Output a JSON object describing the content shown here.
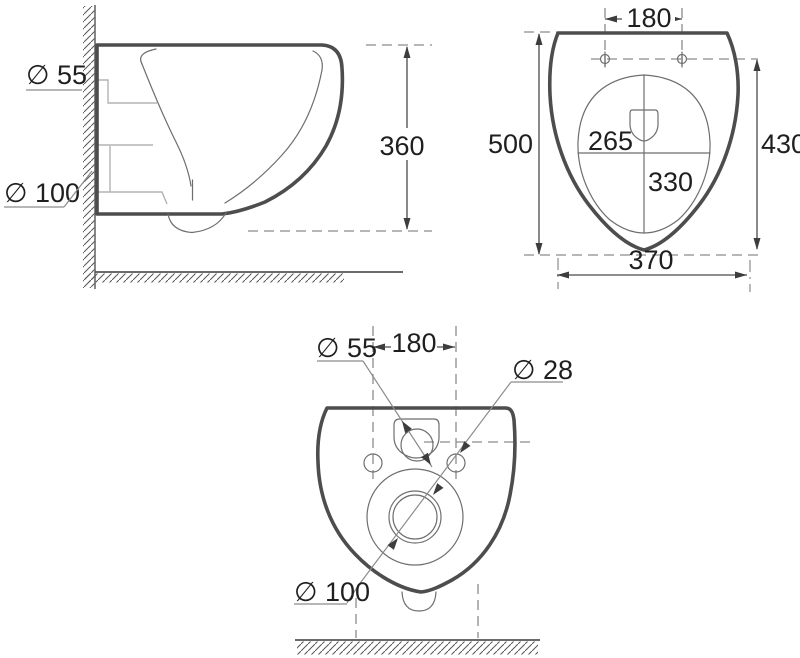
{
  "side_view": {
    "inlet_diameter": "∅ 55",
    "outlet_diameter": "∅ 100",
    "mount_height": "360"
  },
  "top_view": {
    "hole_spacing": "180",
    "total_length": "500",
    "hole_to_front": "430",
    "bowl_width": "370",
    "inner_width": "265",
    "inner_length": "330"
  },
  "bottom_view": {
    "inlet_diameter": "∅ 55",
    "hole_spacing": "180",
    "hole_diameter": "∅ 28",
    "outlet_diameter": "∅ 100"
  },
  "colors": {
    "outline": "#4d4d4d",
    "thin_line": "#6e6e6e",
    "construction": "#b3b3b3",
    "dashed_line": "#8c8c8c",
    "text": "#1f1f1f",
    "background": "#ffffff"
  }
}
